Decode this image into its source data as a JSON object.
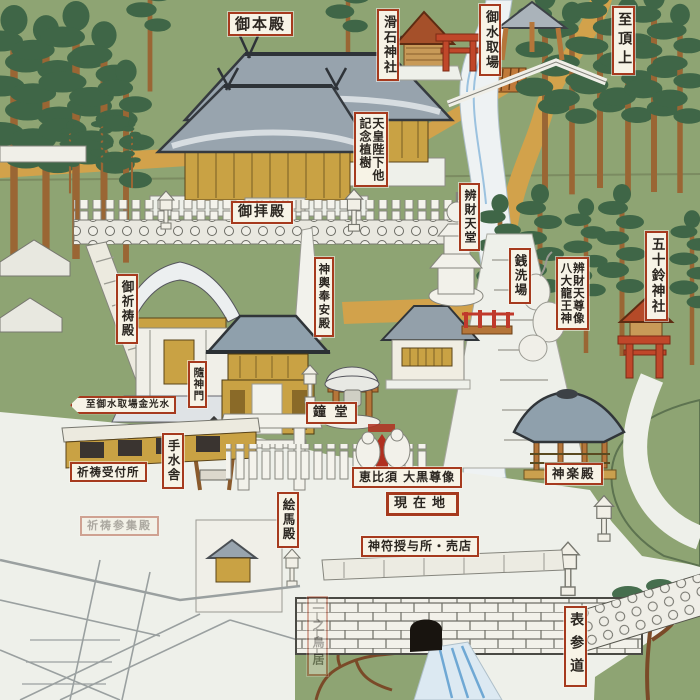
{
  "map": {
    "type": "hand-painted shrine precinct map",
    "labels": {
      "honden": {
        "text": "御本殿"
      },
      "nameraishi": {
        "text": "滑石神社"
      },
      "omizutoriba": {
        "text": "御水取場"
      },
      "to_summit": {
        "text": "至頂上"
      },
      "memorial_tree": {
        "line1": "天皇陛下他",
        "line2": "記念植樹"
      },
      "benzaitendo": {
        "text": "辨財天堂"
      },
      "zeniaraiba": {
        "text": "銭洗場"
      },
      "benzaiten_statue": {
        "line1": "辨財天尊像",
        "line2": "八大龍王神"
      },
      "isuzu_shrine": {
        "text": "五十鈴神社"
      },
      "haiden": {
        "text": "御拝殿"
      },
      "kitoden": {
        "text": "御祈祷殿"
      },
      "mikoshi_hoanden": {
        "text": "神輿奉安殿"
      },
      "zuishinmon": {
        "text": "隨神門"
      },
      "mizutoriba_sign": {
        "text": "至御水取場金光水"
      },
      "shodo": {
        "text": "鐘 堂"
      },
      "chozusha": {
        "text": "手水舎"
      },
      "kito_reception": {
        "text": "祈祷受付所"
      },
      "ebisu_daikoku": {
        "text": "恵比須 大黒尊像"
      },
      "current_location": {
        "text": "現在地"
      },
      "emaden": {
        "text": "絵馬殿"
      },
      "talisman_shop": {
        "text": "神符授与所・売店"
      },
      "kaguraden": {
        "text": "神楽殿"
      },
      "kito_sanshuden": {
        "text": "祈祷参集殿"
      },
      "ichino_torii": {
        "text": "一之鳥居"
      },
      "omotesando": {
        "text": "表参道"
      }
    },
    "colors": {
      "background_green": "#8ea473",
      "tree_green": "#3f6647",
      "trunk_brown": "#9a6634",
      "path_gold": "#d2a24b",
      "roof_gray": "#97a3ad",
      "building_gold": "#c9a244",
      "label_red": "#a63a1e",
      "water_blue": "#7fb2d8",
      "white_paint": "#f0efe8"
    }
  }
}
